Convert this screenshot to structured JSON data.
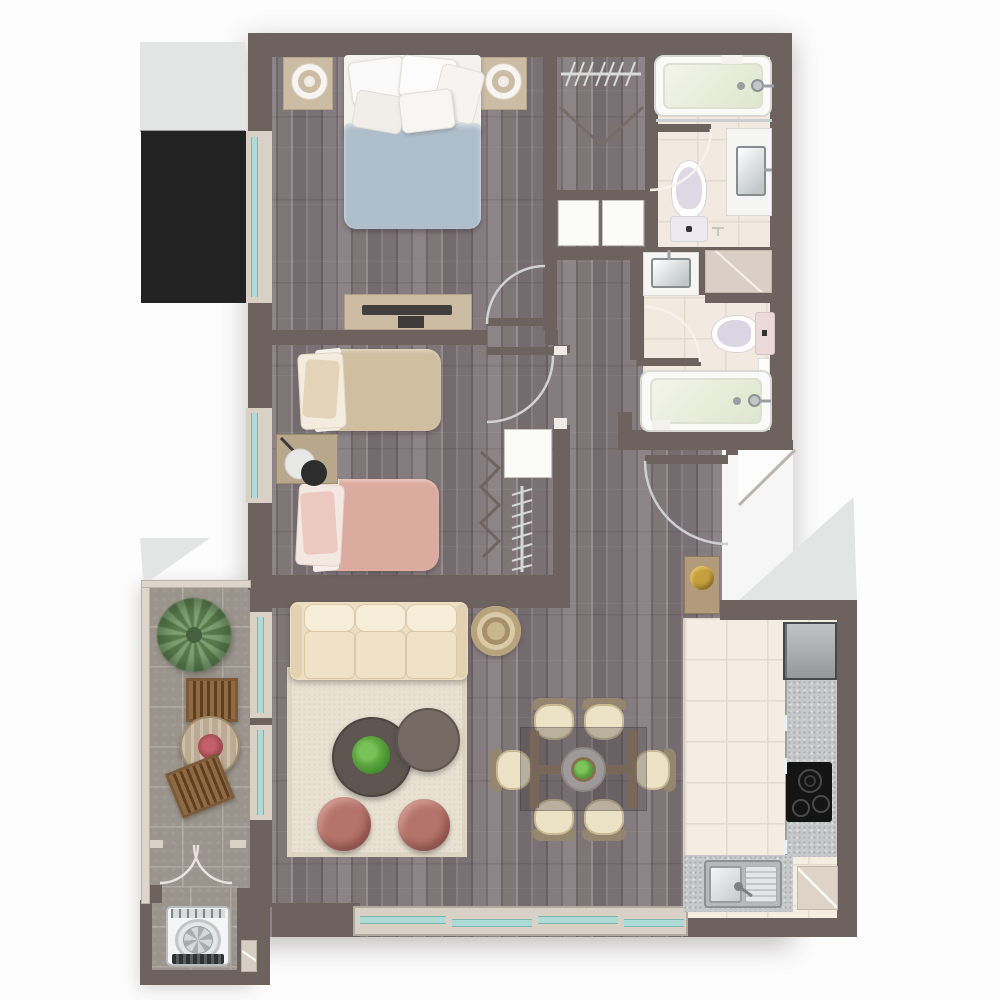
{
  "plan": {
    "type": "apartment-floor-plan",
    "style": "top-down rendered 2-bedroom 2-bath floor plan, no text labels",
    "rooms": [
      {
        "name": "master-bedroom",
        "furniture": [
          "double-bed-blue-duvet",
          "pillows",
          "nightstand-left-with-lamp",
          "nightstand-right-with-lamp",
          "tv-console",
          "left-window",
          "entry-door-arc"
        ]
      },
      {
        "name": "second-bedroom",
        "furniture": [
          "twin-bed-beige",
          "twin-bed-pink",
          "nightstand-with-black-lamp",
          "folding-closet-door",
          "closet-shelf",
          "hanging-rail",
          "left-window",
          "entry-door-arc"
        ]
      },
      {
        "name": "walk-in-closet",
        "furniture": [
          "hanging-rail-with-hangers",
          "double-swing-doors"
        ]
      },
      {
        "name": "hall-storage",
        "furniture": [
          "storage-unit-left",
          "storage-unit-right"
        ]
      },
      {
        "name": "bathroom-top",
        "furniture": [
          "bathtub",
          "vanity-with-sink",
          "toilet",
          "door-arc"
        ]
      },
      {
        "name": "bathroom-middle",
        "furniture": [
          "vanity-with-sink",
          "shower",
          "toilet",
          "bathtub",
          "door-arc"
        ]
      },
      {
        "name": "entry-hallway",
        "furniture": [
          "entry-door-arc",
          "console-table-with-gold-flowers"
        ]
      },
      {
        "name": "living-room",
        "furniture": [
          "cream-sofa",
          "area-rug",
          "coffee-table-large-with-plant",
          "coffee-table-small",
          "rose-pouf-left",
          "rose-pouf-right",
          "round-jute-pouf"
        ]
      },
      {
        "name": "dining-area",
        "furniture": [
          "glass-dining-table",
          "centerpiece-plant",
          "chair-top-left",
          "chair-top-right",
          "chair-bottom-left",
          "chair-bottom-right",
          "chair-left",
          "chair-right"
        ]
      },
      {
        "name": "kitchen",
        "furniture": [
          "fridge",
          "stone-counter",
          "induction-cooktop",
          "sink-with-drainboard",
          "appliance-pad"
        ]
      },
      {
        "name": "balcony",
        "furniture": [
          "palm-plant",
          "round-bistro-table-with-flowers",
          "wood-chair-top",
          "wood-chair-bottom",
          "french-doors"
        ]
      },
      {
        "name": "laundry-nook",
        "furniture": [
          "top-load-washing-machine",
          "threshold-pad"
        ]
      }
    ],
    "exterior_elements": [
      "neighbor-gray-block-top-left",
      "dark-shaft-block",
      "entry-cut-triangles",
      "balcony-corner-triangle"
    ]
  },
  "palette": {
    "wall": "#6e625e",
    "wood_mid": "#837a7d",
    "tile_bath": "#f2eae1",
    "tile_bath_line": "#e4dacd",
    "tile_kitchen": "#f5ece2",
    "tile_kitchen_line": "#e7ddd0",
    "tile_balcony": "#9a948c",
    "tile_balcony_line": "#aeaaa2",
    "counter": "#c6c8c9",
    "sill": "#d9d1c6",
    "glass": "#aedbd8",
    "exterior_light": "#e3e4e4",
    "exterior_dark": "#232323",
    "duvet_master": "#afbecb",
    "duvet_beige": "#d0bea1",
    "duvet_pink": "#dcab9f",
    "sofa_cream": "#eedfc4",
    "rug": "#e9e2d3",
    "pouf_rose": "#b5746b",
    "table_dark": "#5e5551",
    "chair_seat": "#ece2c6",
    "chair_back": "#94866f",
    "plant_green": "#5ca33f",
    "balcony_wood": "#7c5a38",
    "gold_flowers": "#c69f3f",
    "cooktop": "#141414",
    "fixture_white": "#f5f5f3"
  }
}
